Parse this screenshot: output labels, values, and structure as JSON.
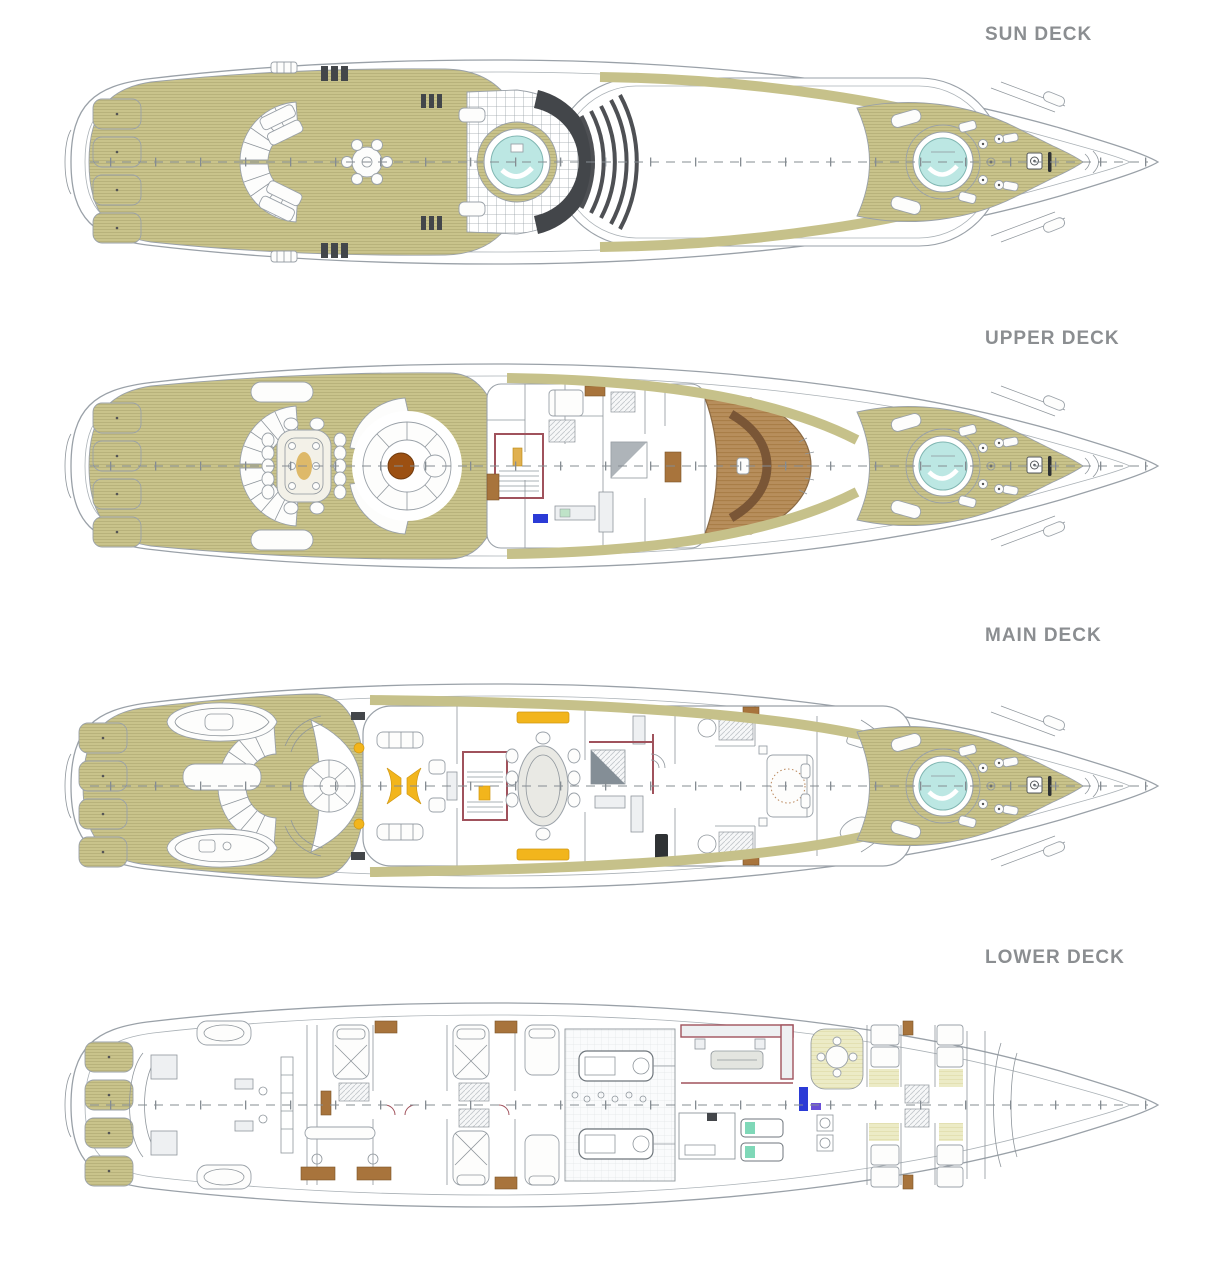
{
  "decks": [
    {
      "id": "sun-deck",
      "label": "SUN DECK"
    },
    {
      "id": "upper-deck",
      "label": "UPPER DECK"
    },
    {
      "id": "main-deck",
      "label": "MAIN DECK"
    },
    {
      "id": "lower-deck",
      "label": "LOWER DECK"
    }
  ],
  "colors": {
    "teak_decking": "#c9c38b",
    "label_text": "#8b8e91",
    "hot_tub_water": "#bce7e3",
    "dark_structure": "#4e5054",
    "wheelhouse_wood": "#b78e5c",
    "accent_gold": "#f2b51c",
    "accent_maroon": "#a0525c",
    "accent_brown": "#a8743c",
    "accent_blue": "#2b3bd6",
    "accent_green": "#7fd8b8",
    "crew_floor": "#ecebc6"
  }
}
